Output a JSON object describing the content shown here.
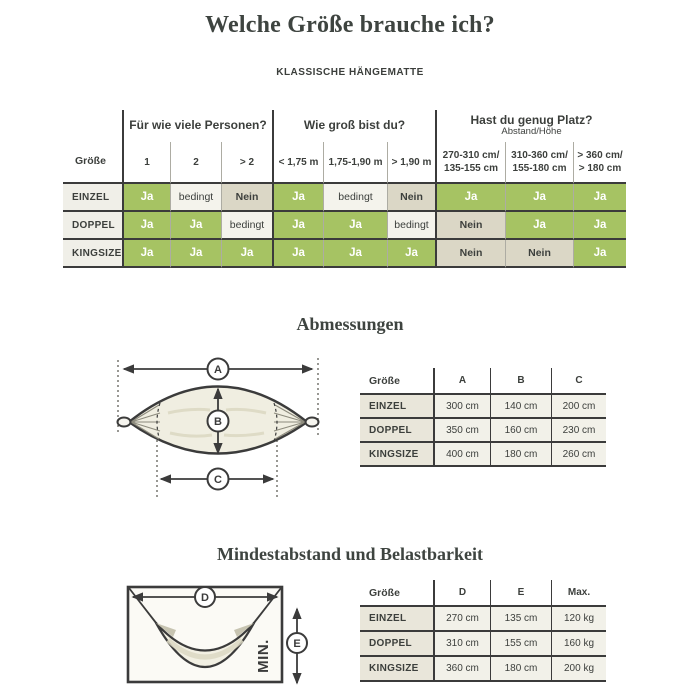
{
  "header": {
    "title": "Welche Größe brauche ich?",
    "subtitle": "KLASSISCHE HÄNGEMATTE"
  },
  "size_table": {
    "corner": "Größe",
    "groups": [
      {
        "label": "Für wie viele Personen?"
      },
      {
        "label": "Wie groß bist du?"
      },
      {
        "label": "Hast du genug Platz?",
        "sub": "Abstand/Höhe"
      }
    ],
    "columns": [
      "1",
      "2",
      "> 2",
      "< 1,75 m",
      "1,75-1,90 m",
      "> 1,90 m",
      "270-310 cm/\n135-155 cm",
      "310-360 cm/\n155-180 cm",
      "> 360 cm/\n> 180 cm"
    ],
    "rows": [
      {
        "label": "EINZEL",
        "cells": [
          "Ja",
          "bedingt",
          "Nein",
          "Ja",
          "bedingt",
          "Nein",
          "Ja",
          "Ja",
          "Ja"
        ]
      },
      {
        "label": "DOPPEL",
        "cells": [
          "Ja",
          "Ja",
          "bedingt",
          "Ja",
          "Ja",
          "bedingt",
          "Nein",
          "Ja",
          "Ja"
        ]
      },
      {
        "label": "KINGSIZE",
        "cells": [
          "Ja",
          "Ja",
          "Ja",
          "Ja",
          "Ja",
          "Ja",
          "Nein",
          "Nein",
          "Ja"
        ]
      }
    ]
  },
  "abmessungen": {
    "heading": "Abmessungen",
    "labels": {
      "a": "A",
      "b": "B",
      "c": "C"
    },
    "table": {
      "headers": [
        "Größe",
        "A",
        "B",
        "C"
      ],
      "rows": [
        {
          "label": "EINZEL",
          "values": [
            "300 cm",
            "140 cm",
            "200 cm"
          ]
        },
        {
          "label": "DOPPEL",
          "values": [
            "350 cm",
            "160 cm",
            "230 cm"
          ]
        },
        {
          "label": "KINGSIZE",
          "values": [
            "400 cm",
            "180 cm",
            "260 cm"
          ]
        }
      ]
    }
  },
  "mindestabstand": {
    "heading": "Mindestabstand und Belastbarkeit",
    "labels": {
      "d": "D",
      "e": "E",
      "min": "MIN."
    },
    "table": {
      "headers": [
        "Größe",
        "D",
        "E",
        "Max."
      ],
      "rows": [
        {
          "label": "EINZEL",
          "values": [
            "270 cm",
            "135 cm",
            "120 kg"
          ]
        },
        {
          "label": "DOPPEL",
          "values": [
            "310 cm",
            "155 cm",
            "160 kg"
          ]
        },
        {
          "label": "KINGSIZE",
          "values": [
            "360 cm",
            "180 cm",
            "200 kg"
          ]
        }
      ]
    }
  },
  "colors": {
    "green": "#a6c363",
    "cream": "#f4f3ec",
    "tan": "#dbd7c6",
    "line": "#3b3b3b",
    "labelbg": "#f0efe8",
    "beige": "#e9e6da",
    "cell": "#f2f1e9",
    "text": "#3c3f3c"
  }
}
